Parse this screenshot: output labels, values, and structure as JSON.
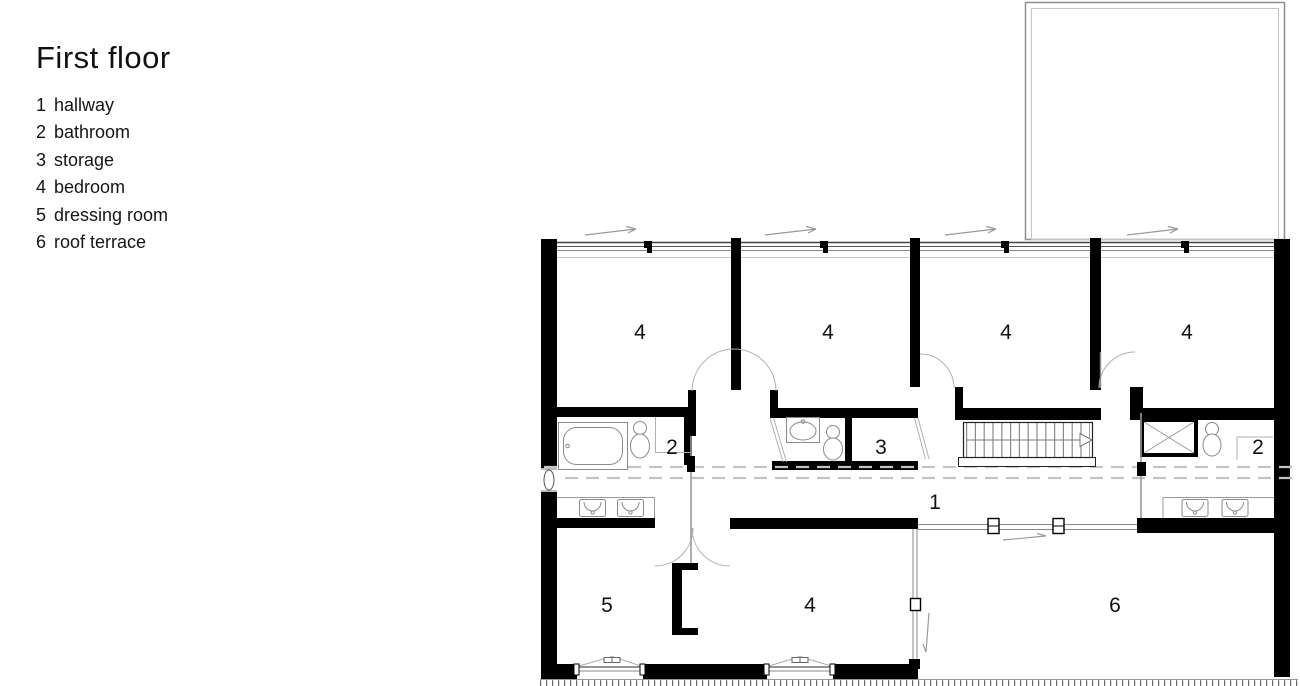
{
  "title": "First floor",
  "legend": {
    "items": [
      {
        "num": "1",
        "name": "hallway"
      },
      {
        "num": "2",
        "name": "bathroom"
      },
      {
        "num": "3",
        "name": "storage"
      },
      {
        "num": "4",
        "name": "bedroom"
      },
      {
        "num": "5",
        "name": "dressing room"
      },
      {
        "num": "6",
        "name": "roof terrace"
      }
    ]
  },
  "plan": {
    "room_labels": [
      {
        "text": "4",
        "room": "bedroom-1"
      },
      {
        "text": "4",
        "room": "bedroom-2"
      },
      {
        "text": "4",
        "room": "bedroom-3"
      },
      {
        "text": "4",
        "room": "bedroom-4"
      },
      {
        "text": "2",
        "room": "bathroom-left"
      },
      {
        "text": "3",
        "room": "storage"
      },
      {
        "text": "2",
        "room": "bathroom-right"
      },
      {
        "text": "1",
        "room": "hallway"
      },
      {
        "text": "5",
        "room": "dressing-room"
      },
      {
        "text": "4",
        "room": "bedroom-bottom"
      },
      {
        "text": "6",
        "room": "roof-terrace"
      }
    ],
    "colors": {
      "walls": "#000000",
      "fixture_lines": "#8a8a8a",
      "door_arcs": "#b0b0b0",
      "dashed_guides": "#c4c4c4",
      "text": "#111111"
    }
  }
}
